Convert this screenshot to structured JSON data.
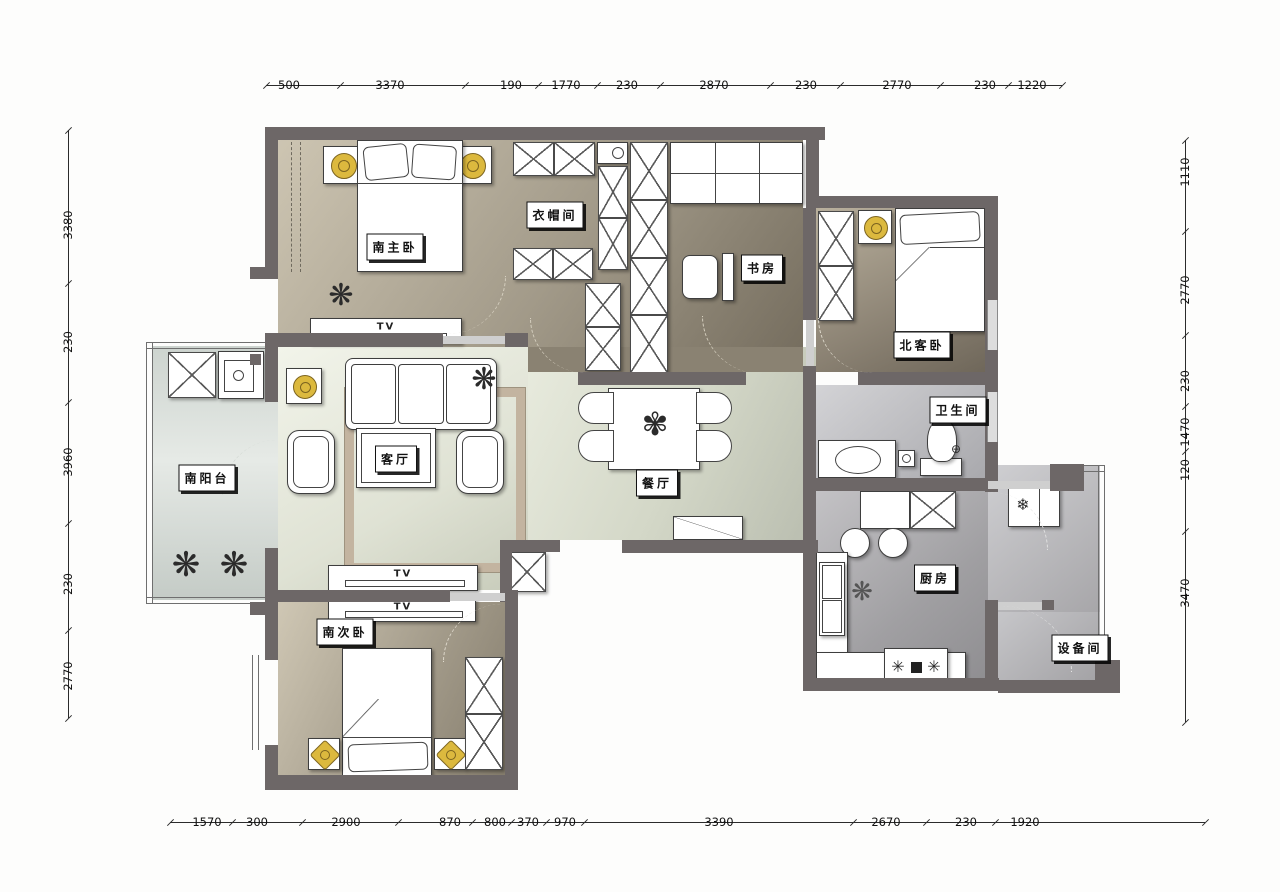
{
  "plan": {
    "rooms": {
      "master_bedroom": "南主卧",
      "cloakroom": "衣帽间",
      "study": "书房",
      "north_guest_bedroom": "北客卧",
      "bathroom": "卫生间",
      "living_room": "客厅",
      "south_balcony": "南阳台",
      "dining_room": "餐厅",
      "kitchen": "厨房",
      "equipment_room": "设备间",
      "south_second_bedroom": "南次卧"
    },
    "furniture_labels": {
      "tv": "TV"
    },
    "dimensions_mm": {
      "top": [
        "500",
        "3370",
        "190",
        "1770",
        "230",
        "2870",
        "230",
        "2770",
        "230",
        "1220"
      ],
      "bottom": [
        "1570",
        "300",
        "2900",
        "870",
        "800",
        "370",
        "970",
        "3390",
        "2670",
        "230",
        "1920"
      ],
      "left": [
        "3380",
        "230",
        "3960",
        "230",
        "2770"
      ],
      "right": [
        "1110",
        "2770",
        "230",
        "1470",
        "120",
        "3470"
      ]
    },
    "colors": {
      "wall": "#6d6767",
      "lamp_accent": "#dcb93e",
      "floor_bedroom_dark": "#7e7666",
      "floor_bedroom_light": "#cdc5b2",
      "floor_living": "#eef0e6",
      "floor_kitchen": "#a9a8ab",
      "floor_balcony": "#d8ded9"
    }
  }
}
